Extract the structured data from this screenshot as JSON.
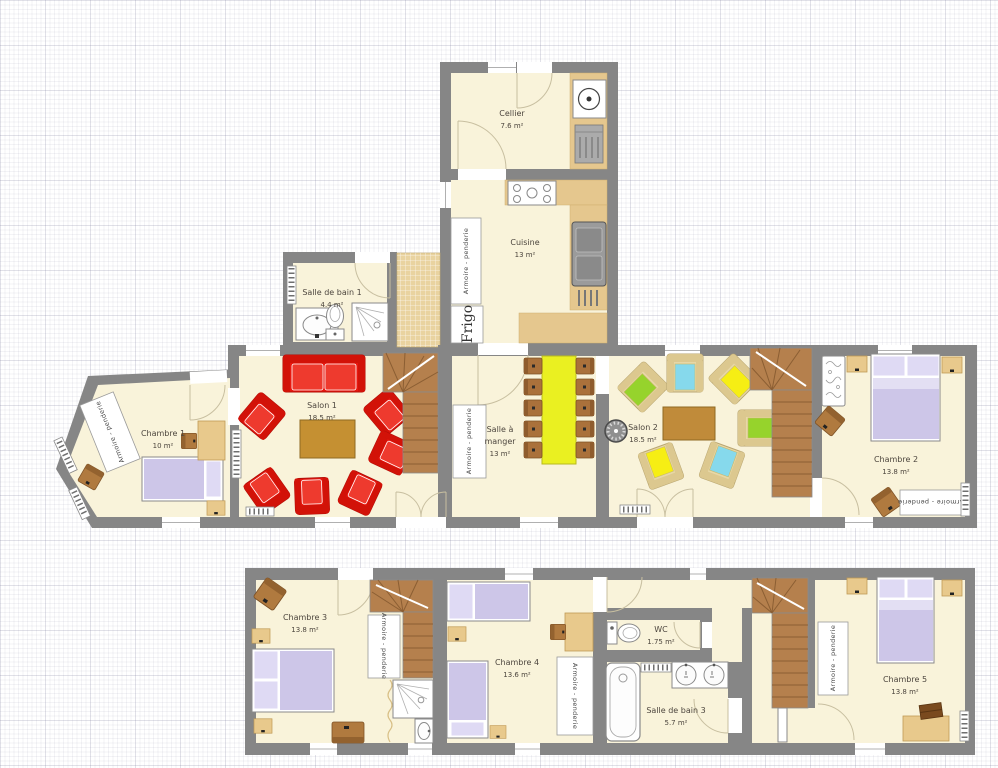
{
  "plan": {
    "title": "Plan de maison",
    "armoire_label": "Armoire - penderie",
    "frigo_label": "Frigo",
    "rooms": {
      "cellier": {
        "name": "Cellier",
        "area": "7.6 m²"
      },
      "cuisine": {
        "name": "Cuisine",
        "area": "13 m²"
      },
      "salle_de_bain_1": {
        "name": "Salle de bain 1",
        "area": "4.4 m²"
      },
      "salon_1": {
        "name": "Salon 1",
        "area": "18.5 m²"
      },
      "salle_a_manger": {
        "name_line1": "Salle à",
        "name_line2": "manger",
        "area": "13 m²"
      },
      "salon_2": {
        "name": "Salon 2",
        "area": "18.5 m²"
      },
      "chambre_1": {
        "name": "Chambre 1",
        "area": "10 m²"
      },
      "chambre_2": {
        "name": "Chambre 2",
        "area": "13.8 m²"
      },
      "chambre_3": {
        "name": "Chambre 3",
        "area": "13.8 m²"
      },
      "chambre_4": {
        "name": "Chambre 4",
        "area": "13.6 m²"
      },
      "wc": {
        "name": "WC",
        "area": "1.75 m²"
      },
      "salle_de_bain_3": {
        "name": "Salle de bain 3",
        "area": "5.7 m²"
      },
      "chambre_5": {
        "name": "Chambre 5",
        "area": "13.8 m²"
      }
    },
    "colors": {
      "wall": "#868686",
      "floor": "#f9f3da",
      "sofa_red": "#e8170f",
      "dining_table_yellow": "#eaf021",
      "coffee_table_gold": "#c59032",
      "stair_brown": "#b5804d",
      "bed_lavender": "#cdc6e8",
      "counter_tan": "#e5c78e",
      "cushion_green": "#96d32c",
      "cushion_blue": "#86d9ec",
      "cushion_yellow": "#f6ee14"
    }
  }
}
